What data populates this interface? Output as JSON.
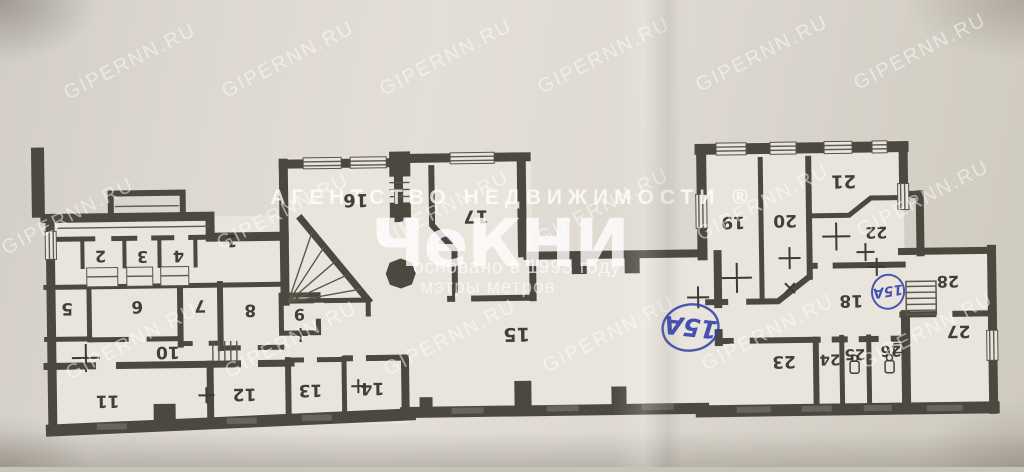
{
  "document": {
    "kind": "scanned floor plan photograph",
    "orientation_note": "printed plan appears rotated 180 degrees"
  },
  "watermark": {
    "site": "GIPERNN.RU",
    "agency_line": "АГЕНТСТВО   НЕДВИЖИМОСТИ  ®",
    "brand": "ЧеКНИ",
    "founded_line": "основано в 1993 году",
    "slogan_line": "мэтры метров"
  },
  "room_numbers": [
    "1",
    "2",
    "3",
    "4",
    "5",
    "6",
    "7",
    "8",
    "9",
    "10",
    "11",
    "12",
    "13",
    "14",
    "15",
    "16",
    "17",
    "18",
    "19",
    "20",
    "21",
    "22",
    "23",
    "24",
    "25",
    "26",
    "27",
    "28"
  ],
  "annotations": {
    "unit_mark_large": "15А",
    "unit_mark_small": "15А"
  },
  "colors": {
    "paper": "#dcd7cf",
    "room_fill": "#e9e5dc",
    "wall_ink": "#4b483f",
    "pen_blue": "#2e3da8",
    "watermark": "#ffffff"
  }
}
